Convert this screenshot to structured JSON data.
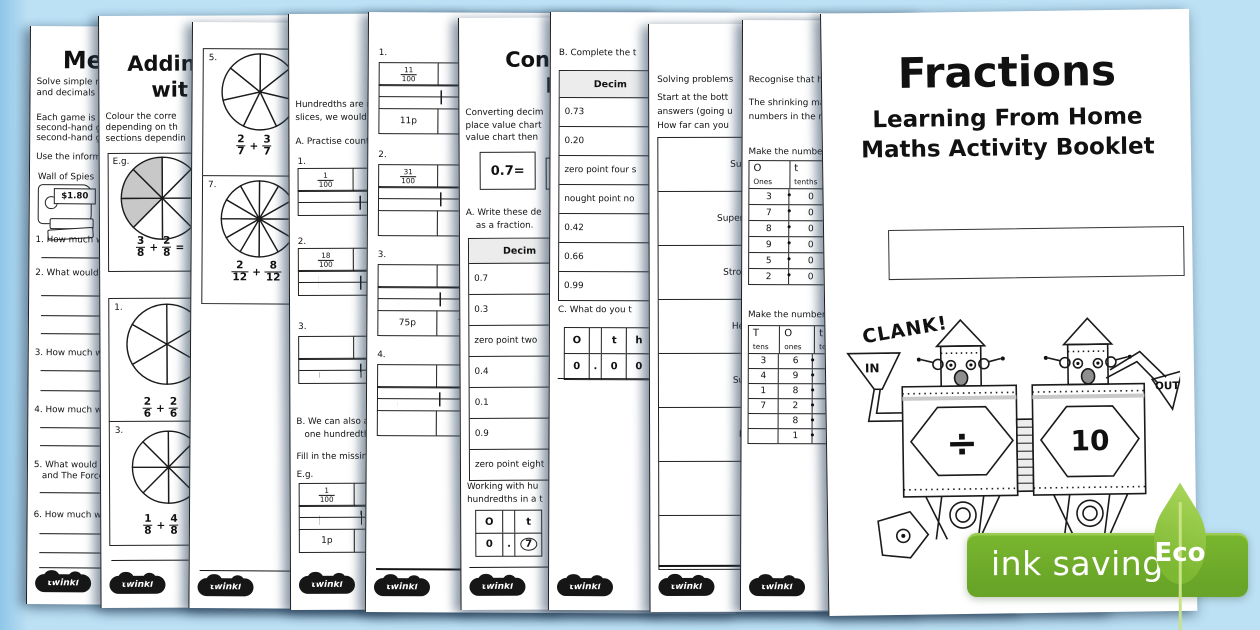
{
  "symbols": {
    "plus": "+",
    "equals": "=",
    "dot": "•"
  },
  "twinkl": "twinkl",
  "badge": {
    "label": "ink saving",
    "eco": "Eco"
  },
  "cover": {
    "title": "Fractions",
    "sub1": "Learning From Home",
    "sub2": "Maths Activity Booklet",
    "robot": {
      "clank": "CLANK!",
      "in": "IN",
      "out": "OUT",
      "op": "÷",
      "val": "10"
    }
  },
  "pages": {
    "p1": {
      "title": "Me",
      "l1": "Solve simple mea",
      "l2": "and decimals to t",
      "l3": "Each game is av",
      "l4": "second-hand gam",
      "l5": "second-hand gam",
      "l6": "Use the informati",
      "shop": "Wall of Spies",
      "price": "$1.80",
      "q1": "1. How much wo",
      "q2": "2. What would t",
      "q3": "3. How much wo",
      "q4": "4. How much wo",
      "q5a": "5. What would th",
      "q5b": "and The Force",
      "q6": "6. How much wo"
    },
    "p2": {
      "title1": "Addin",
      "title2": "wit",
      "l1": "Colour the corre",
      "l2": "depending on th",
      "l3": "sections dependin",
      "eg_label": "E.g.",
      "eg": {
        "slices": "8",
        "shaded": "5,6,7",
        "f1n": "3",
        "f1d": "8",
        "f2n": "2",
        "f2d": "8"
      },
      "i1": {
        "num": "1.",
        "slices": "6",
        "f1n": "2",
        "f1d": "6",
        "f2n": "2",
        "f2d": "6"
      },
      "i2": {
        "num": "3.",
        "slices": "8",
        "f1n": "1",
        "f1d": "8",
        "f2n": "4",
        "f2d": "8"
      }
    },
    "p3": {
      "i1": {
        "num": "5.",
        "slices": "7",
        "f1n": "2",
        "f1d": "7",
        "f2n": "3",
        "f2d": "7"
      },
      "i2": {
        "num": "7.",
        "slices": "12",
        "f1n": "2",
        "f1d": "12",
        "f2n": "8",
        "f2d": "12"
      }
    },
    "p4": {
      "l1": "Hundredths are m",
      "l2": "slices, we would l",
      "secA": "A. Practise count",
      "n1": "1.",
      "c1a_n": "1",
      "c1a_d": "100",
      "c1b_n": "2",
      "c1b_d": "100",
      "n2": "2.",
      "c2a_n": "18",
      "c2a_d": "100",
      "n3": "3.",
      "secB1": "B. We can also a",
      "secB2": "one hundredth",
      "fill": "Fill in the missin",
      "eg_label": "E.g.",
      "ega_n": "1",
      "ega_d": "100",
      "egb_n": "2",
      "egb_d": "100",
      "m1": "1p",
      "m2": "2p"
    },
    "p5": {
      "n1": "1.",
      "c1_n": "11",
      "c1_d": "100",
      "m1": "11p",
      "n2": "2.",
      "c2a_n": "31",
      "c2a_d": "100",
      "c2b_n": "32",
      "c2b_d": "100",
      "n3": "3.",
      "m3a": "75p",
      "m3b": "76p",
      "n4": "4."
    },
    "p6": {
      "title1": "Conv",
      "title2": "H",
      "l1": "Converting decim",
      "l2": "place value chart",
      "l3": "value chart then",
      "box": "0.7=",
      "secA1": "A. Write these de",
      "secA2": "as a fraction.",
      "header": "Decim",
      "rows": [
        "0.7",
        "0.3",
        "zero point two",
        "0.4",
        "0.1",
        "0.9",
        "zero point eight"
      ],
      "w1": "Working with hu",
      "w2": "hundredths in a t",
      "pvO": "O",
      "pvT": "t",
      "r0": "0",
      "rdot": ".",
      "r7": "7"
    },
    "p7": {
      "secB": "B. Complete the t",
      "header": "Decim",
      "rows": [
        "0.73",
        "0.20",
        "zero point four s",
        "nought point no",
        "0.42",
        "0.66",
        "0.99"
      ],
      "secC": "C. What do you t",
      "pvO": "O",
      "pvT": "t",
      "pvH": "h",
      "r0": "0",
      "rdot": ".",
      "ra": "0",
      "rb": "0"
    },
    "p8": {
      "intro": "Solving problems",
      "l1": "Start at the bott",
      "l2": "answers (going u",
      "l3": "How far can you",
      "ladder": [
        "Superhum",
        "Super Strong he",
        "Strong Heavy",
        "Heavywei",
        "Super Str",
        "Powerf",
        "Muscl",
        "Strong"
      ]
    },
    "p9": {
      "intro": "Recognise that hu",
      "l1": "The shrinking ma",
      "l2": "numbers in the n",
      "make1": "Make the number",
      "t1": {
        "h": [
          [
            "O",
            "Ones"
          ],
          [
            "t",
            "tenths"
          ],
          [
            "h",
            "h"
          ]
        ],
        "rows": [
          [
            "3",
            "0"
          ],
          [
            "7",
            "0"
          ],
          [
            "8",
            "0"
          ],
          [
            "9",
            "0"
          ],
          [
            "5",
            "0"
          ],
          [
            "2",
            "0"
          ]
        ]
      },
      "make2": "Make the number",
      "t2": {
        "h": [
          [
            "T",
            "tens"
          ],
          [
            "O",
            "ones"
          ],
          [
            "t",
            "tenth"
          ]
        ],
        "rows": [
          [
            "3",
            "6"
          ],
          [
            "4",
            "9"
          ],
          [
            "1",
            "8"
          ],
          [
            "7",
            "2"
          ],
          [
            "",
            "8"
          ],
          [
            "",
            "1"
          ]
        ]
      }
    }
  }
}
